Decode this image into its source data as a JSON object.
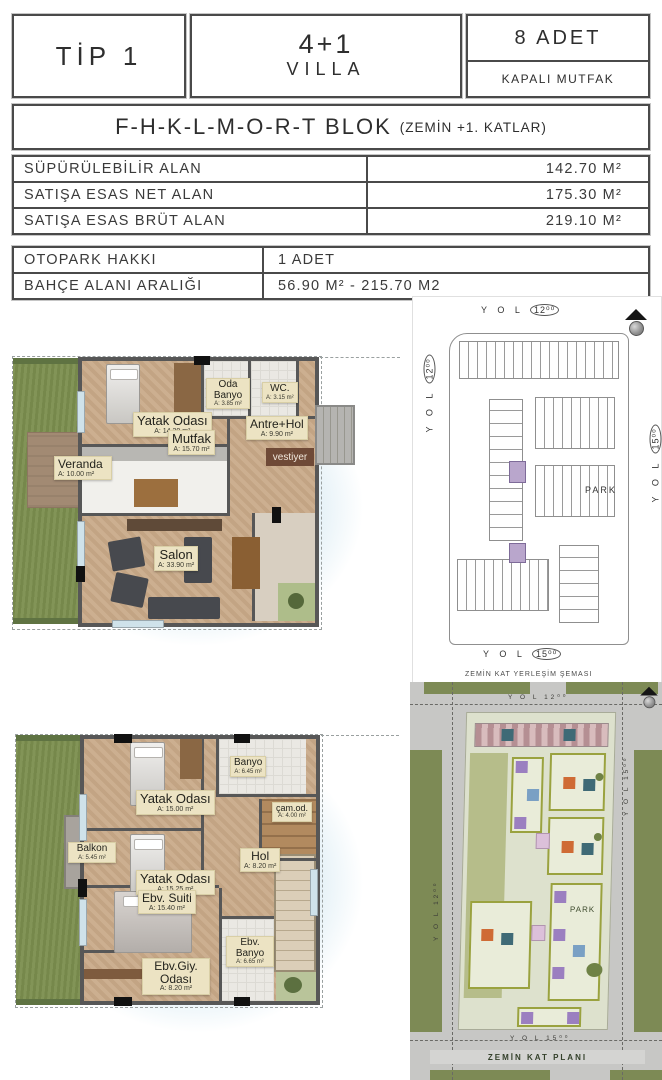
{
  "header": {
    "tip": "TİP 1",
    "unit_type": "4+1",
    "unit_kind": "VILLA",
    "count": "8 ADET",
    "kitchen": "KAPALI MUTFAK",
    "block": "F-H-K-L-M-O-R-T BLOK",
    "block_floors": "(ZEMİN +1. KATLAR)"
  },
  "area_table": {
    "rows": [
      {
        "label": "SÜPÜRÜLEBİLİR ALAN",
        "value": "142.70 M²"
      },
      {
        "label": "SATIŞA ESAS NET ALAN",
        "value": "175.30 M²"
      },
      {
        "label": "SATIŞA ESAS BRÜT ALAN",
        "value": "219.10 M²"
      }
    ]
  },
  "info_table": {
    "rows": [
      {
        "label": "OTOPARK HAKKI",
        "value": "1 ADET"
      },
      {
        "label": "BAHÇE ALANI ARALIĞI",
        "value": "56.90 M² - 215.70 M2"
      }
    ]
  },
  "plans": {
    "ground": {
      "rooms": {
        "yatak": {
          "name": "Yatak Odası",
          "area": "A: 14.20 m²"
        },
        "oda_banyo": {
          "name": "Oda Banyo",
          "area": "A: 3.85 m²"
        },
        "wc": {
          "name": "WC.",
          "area": "A: 3.15 m²"
        },
        "antre": {
          "name": "Antre+Hol",
          "area": "A: 9.90 m²"
        },
        "vestiyer": {
          "name": "vestiyer"
        },
        "mutfak": {
          "name": "Mutfak",
          "area": "A: 15.70 m²"
        },
        "veranda": {
          "name": "Veranda",
          "area": "A: 10.00 m²"
        },
        "salon": {
          "name": "Salon",
          "area": "A: 33.90 m²"
        }
      }
    },
    "first": {
      "rooms": {
        "yatak1": {
          "name": "Yatak Odası",
          "area": "A: 15.00 m²"
        },
        "banyo": {
          "name": "Banyo",
          "area": "A: 6.45 m²"
        },
        "cam_od": {
          "name": "çam.od.",
          "area": "A: 4.00 m²"
        },
        "hol": {
          "name": "Hol",
          "area": "A: 8.20 m²"
        },
        "yatak2": {
          "name": "Yatak Odası",
          "area": "A: 15.25 m²"
        },
        "ebv_suit": {
          "name": "Ebv. Suiti",
          "area": "A: 15.40 m²"
        },
        "ebv_banyo": {
          "name": "Ebv. Banyo",
          "area": "A: 6.65 m²"
        },
        "ebv_giy": {
          "name": "Ebv.Giy. Odası",
          "area": "A: 8.20 m²"
        },
        "balkon": {
          "name": "Balkon",
          "area": "A: 5.45 m²"
        }
      }
    }
  },
  "site_top": {
    "road_top": {
      "word": "Y O L",
      "num": "12⁰⁰"
    },
    "road_left": {
      "word": "Y O L",
      "num": "12⁰⁰"
    },
    "road_right": {
      "word": "Y O L",
      "num": "15⁰⁰"
    },
    "road_bottom": {
      "word": "Y O L",
      "num": "15⁰⁰"
    },
    "park": "PARK",
    "caption": "ZEMİN KAT YERLEŞİM ŞEMASI"
  },
  "site_bottom": {
    "road_top": "Y O L 12⁰⁰",
    "road_left": "Y O L 12⁰⁰",
    "road_right": "Y O L 15⁰⁰",
    "road_bottom": "Y O L 15⁰⁰",
    "park": "PARK",
    "caption": "ZEMİN KAT PLANI"
  },
  "colors": {
    "wall": "#575757",
    "wood_floor": "#c9ab8a",
    "garden_green": "#7b8e4e",
    "label_chip": "#ece3c3",
    "site_building_outline": "#9aa23f",
    "site_highlight_purple": "#b9a6cc",
    "road_gray": "#c7c7c5"
  }
}
